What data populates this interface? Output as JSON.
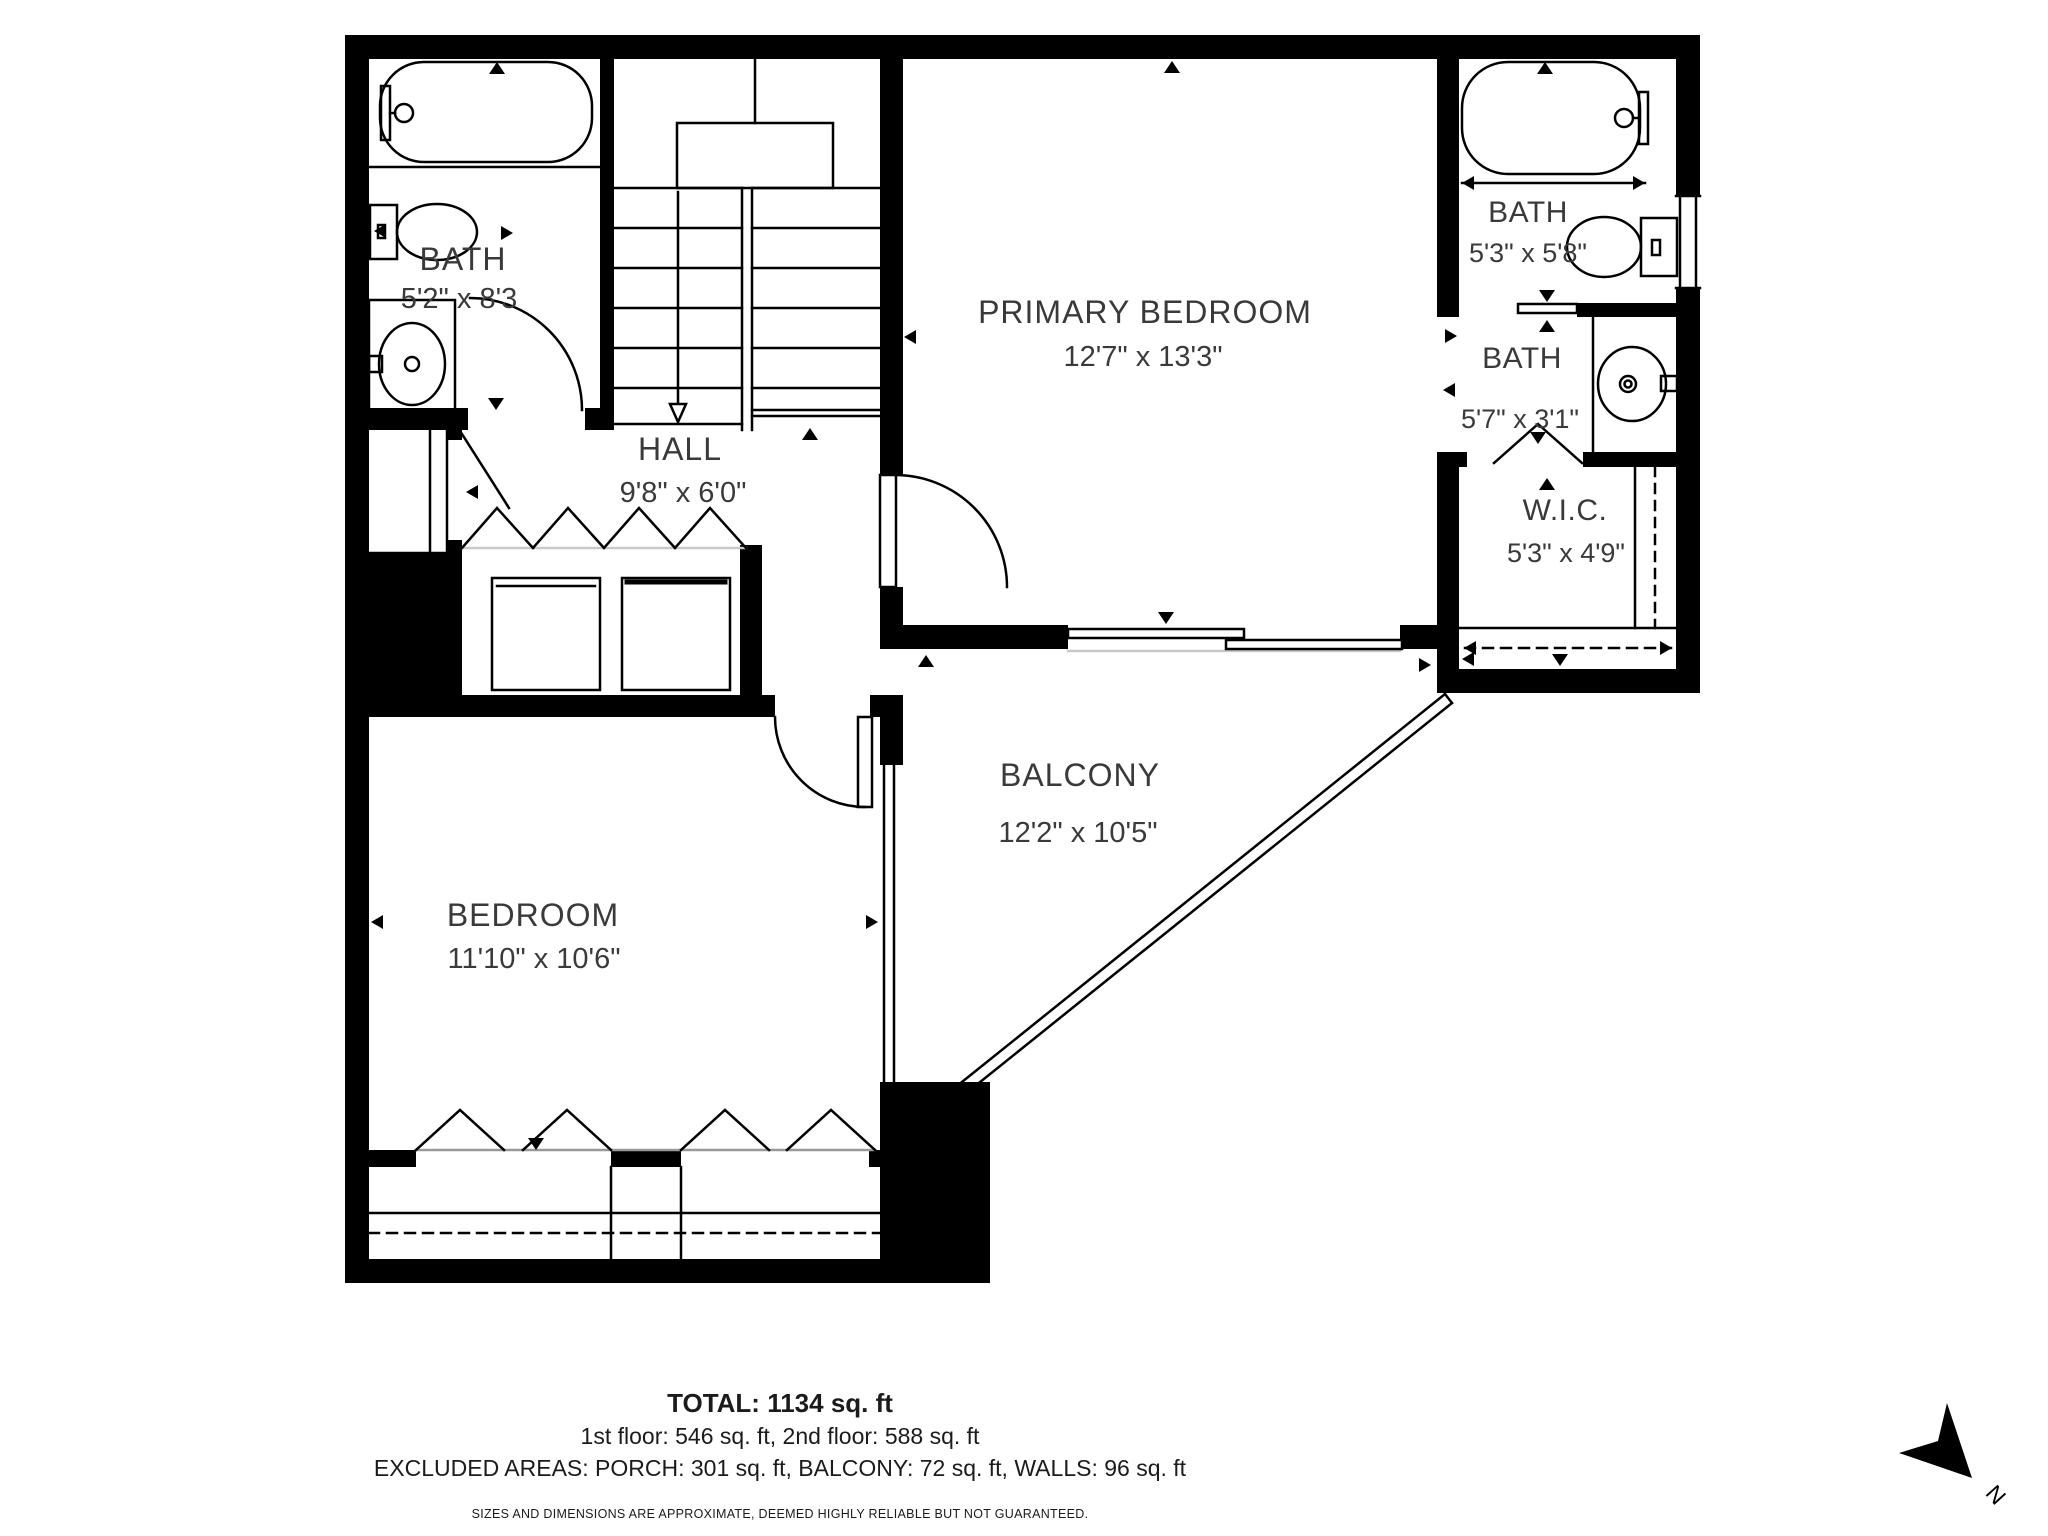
{
  "plan": {
    "rooms": [
      {
        "name": "BATH",
        "dims": "5'2\" x 8'3"
      },
      {
        "name": "HALL",
        "dims": "9'8\" x 6'0\""
      },
      {
        "name": "PRIMARY BEDROOM",
        "dims": "12'7\" x 13'3\""
      },
      {
        "name": "BATH",
        "dims": "5'3\" x 5'8\""
      },
      {
        "name": "BATH",
        "dims": "5'7\" x 3'1\""
      },
      {
        "name": "W.I.C.",
        "dims": "5'3\" x 4'9\""
      },
      {
        "name": "BALCONY",
        "dims": "12'2\" x 10'5\""
      },
      {
        "name": "BEDROOM",
        "dims": "11'10\" x 10'6\""
      }
    ],
    "summary": {
      "total": "TOTAL: 1134 sq. ft",
      "floors": "1st floor: 546 sq. ft, 2nd floor: 588 sq. ft",
      "excluded": "EXCLUDED AREAS: PORCH: 301 sq. ft, BALCONY: 72 sq. ft, WALLS: 96 sq. ft",
      "disclaimer": "SIZES AND DIMENSIONS ARE APPROXIMATE, DEEMED HIGHLY RELIABLE BUT NOT GUARANTEED."
    },
    "compass": {
      "label": "N"
    },
    "colors": {
      "wall": "#000000",
      "room_label": "#3a3a3a",
      "summary_text": "#1b1b1b"
    }
  }
}
